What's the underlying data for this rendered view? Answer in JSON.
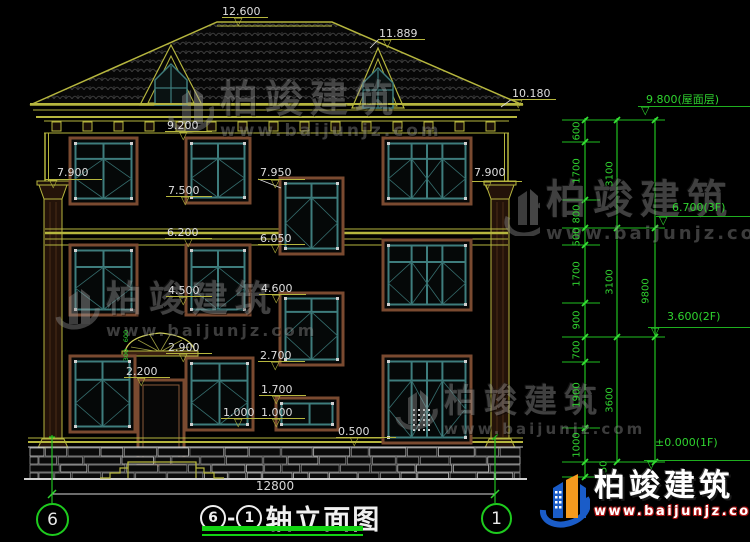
{
  "watermark": {
    "brand": "柏竣建筑",
    "url": "www.baijunjz.com"
  },
  "footer": {
    "brand": "柏竣建筑",
    "url": "www.baijunjz.com"
  },
  "title": {
    "axis_from": "6",
    "separator": "-",
    "axis_to": "1",
    "text": "轴立面图"
  },
  "bottom": {
    "overall_width": "12800",
    "bubble_left": "6",
    "bubble_right": "1"
  },
  "elevation_markers": [
    "12.600",
    "11.889",
    "10.180",
    "9.200",
    "7.900",
    "7.950",
    "7.900",
    "7.500",
    "6.200",
    "6.050",
    "4.500",
    "4.600",
    "2.900",
    "2.700",
    "2.200",
    "1.700",
    "1.000",
    "1.000",
    "0.500"
  ],
  "floor_markers": [
    "9.800(屋面层)",
    "6.700(3F)",
    "3.600(2F)",
    "±0.000(1F)"
  ],
  "dim_chain": {
    "segments": [
      "600",
      "1700",
      "800",
      "500",
      "1700",
      "900",
      "700",
      "1900",
      "1000",
      "450"
    ],
    "subtotals": [
      "3100",
      "3100",
      "3600"
    ],
    "total": "9800"
  },
  "mini_dims": [
    "600",
    "300"
  ],
  "colors": {
    "background": "#000000",
    "line_yellow": "#b6b63e",
    "line_green": "#20c020",
    "line_white": "#d8d8d8",
    "frame_brown": "#7a4a30",
    "frame_teal": "#3e7d7d",
    "logo_blue": "#1a5cc8",
    "logo_orange": "#f59a1e",
    "logo_red": "#cc2020"
  }
}
